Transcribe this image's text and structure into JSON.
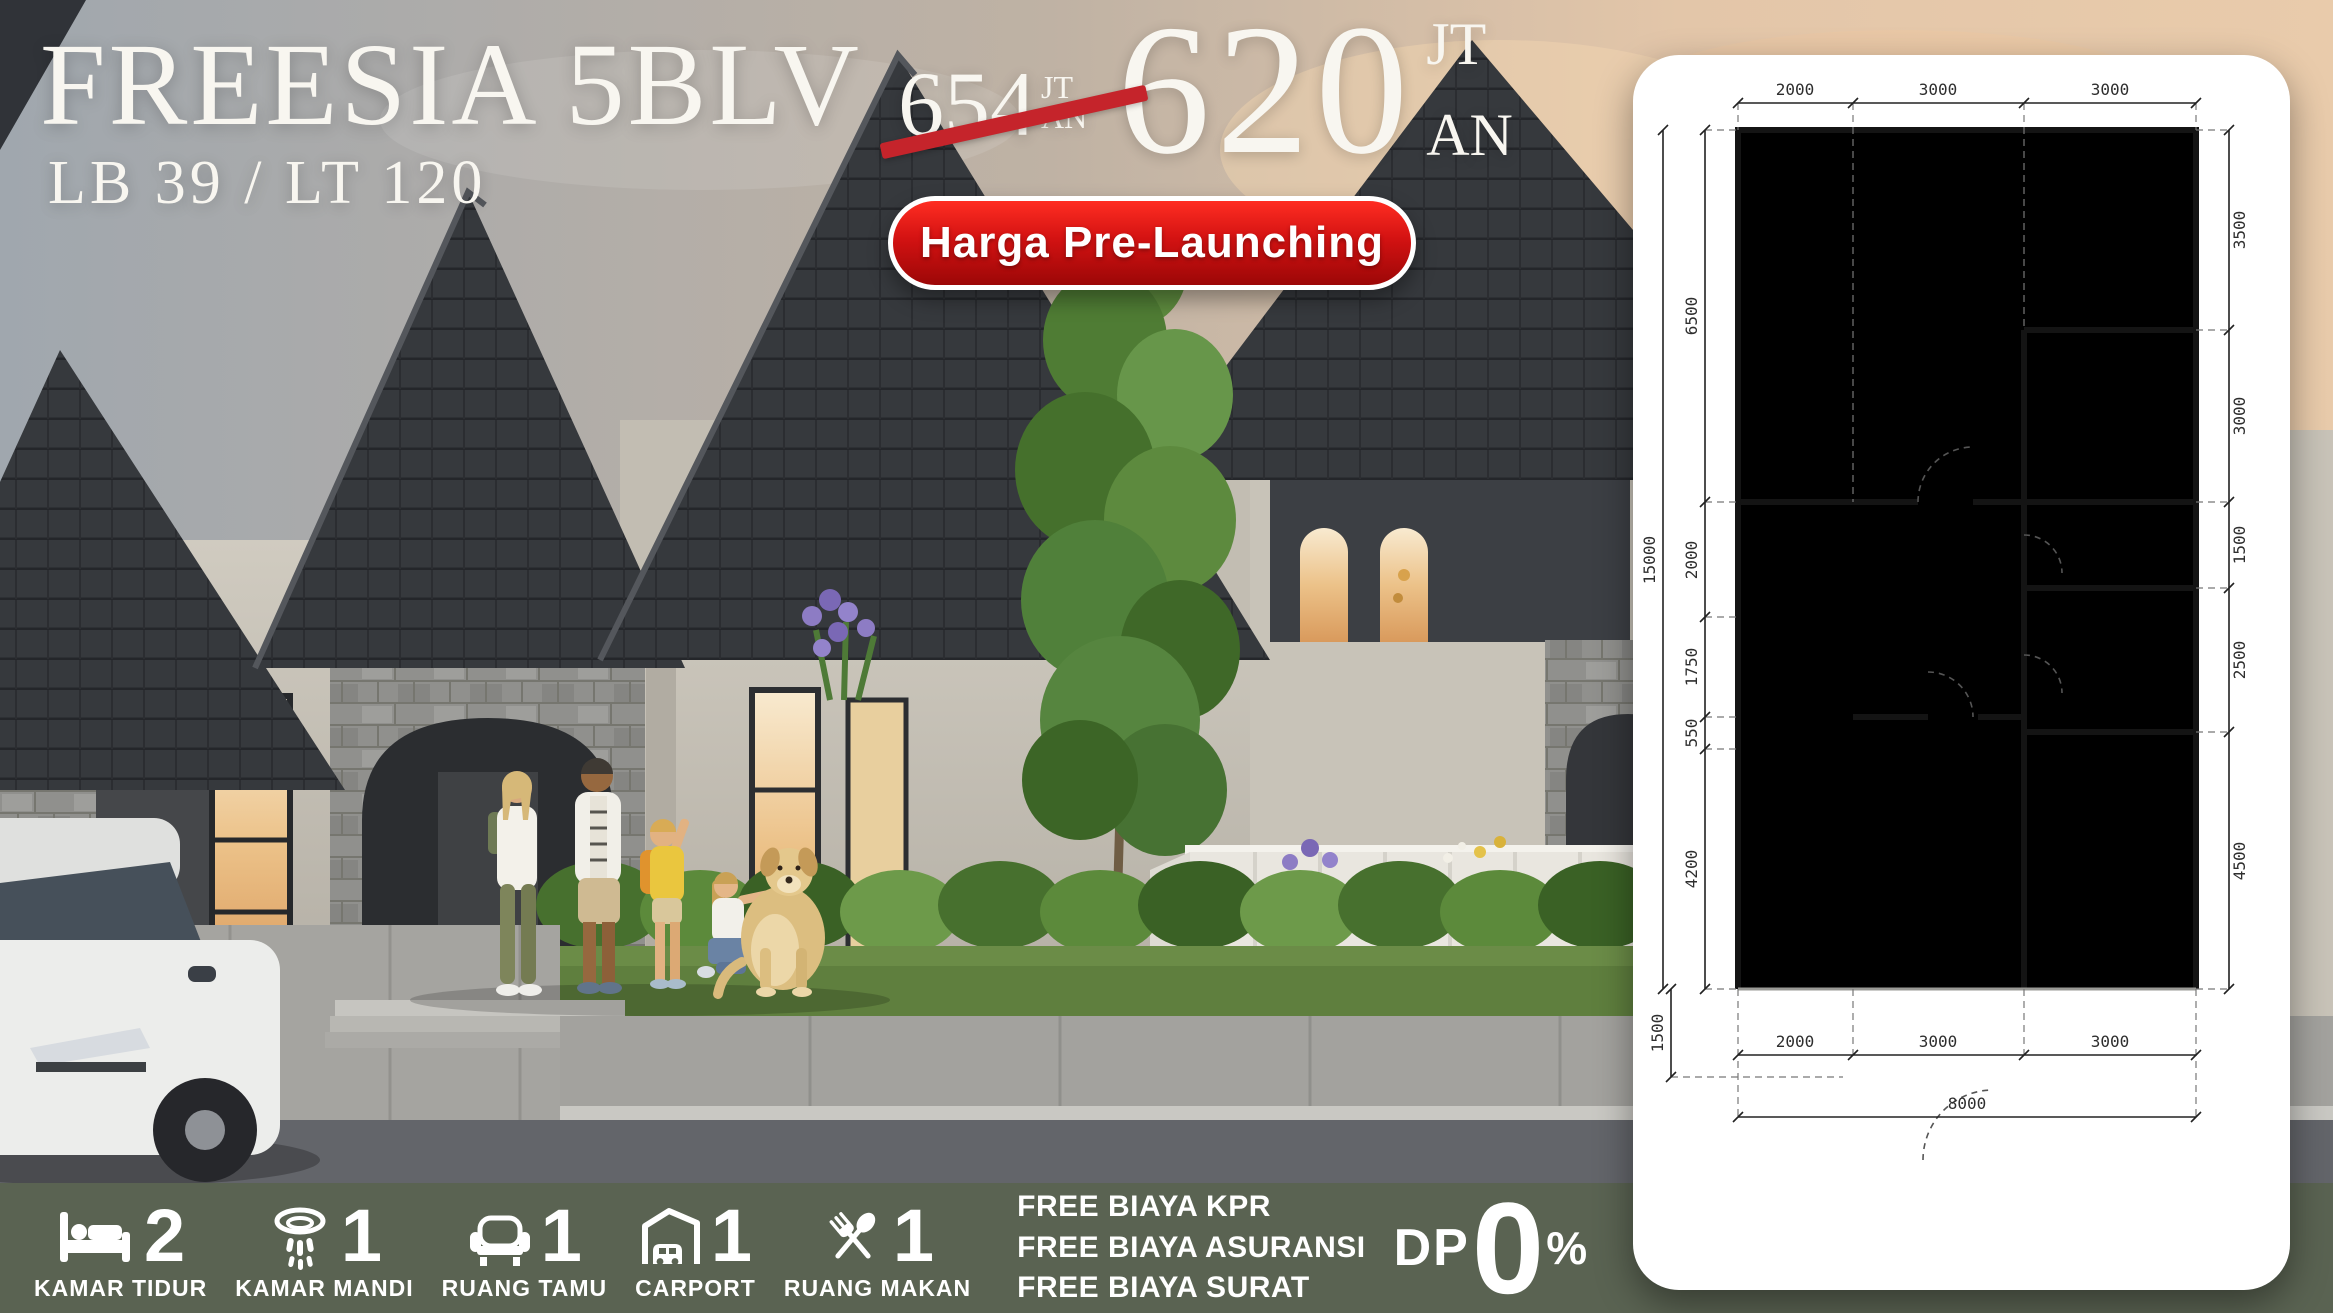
{
  "header": {
    "title": "FREESIA 5BLV",
    "spec": "LB 39 / LT 120"
  },
  "price": {
    "old": {
      "value": "654",
      "unit1": "JT",
      "unit2": "AN"
    },
    "new": {
      "value": "620",
      "unit1": "JT",
      "unit2": "AN"
    }
  },
  "badge": {
    "label": "Harga Pre-Launching"
  },
  "floorplan": {
    "top_dims": [
      "2000",
      "3000",
      "3000"
    ],
    "left_total": "15000",
    "left_dims": [
      "6500",
      "2000",
      "1750",
      "550",
      "4200"
    ],
    "left_front": "1500",
    "right_dims": [
      "3500",
      "3000",
      "1500",
      "2500",
      "4500"
    ],
    "bottom_dims": [
      "2000",
      "3000",
      "3000"
    ],
    "bottom_total": "8000"
  },
  "features": [
    {
      "icon": "bed-icon",
      "count": "2",
      "label": "KAMAR TIDUR"
    },
    {
      "icon": "shower-icon",
      "count": "1",
      "label": "KAMAR MANDI"
    },
    {
      "icon": "sofa-icon",
      "count": "1",
      "label": "RUANG TAMU"
    },
    {
      "icon": "carport-icon",
      "count": "1",
      "label": "CARPORT"
    },
    {
      "icon": "cutlery-icon",
      "count": "1",
      "label": "RUANG MAKAN"
    }
  ],
  "free_items": [
    "FREE BIAYA KPR",
    "FREE BIAYA ASURANSI",
    "FREE BIAYA SURAT"
  ],
  "dp": {
    "prefix": "DP",
    "value": "0",
    "suffix": "%"
  },
  "colors": {
    "accent_red": "#c5242b",
    "badge_red": "#d31212",
    "bar_green": "#5a6352",
    "roof_dark": "#36393d",
    "text_white": "#f8f6f0",
    "plan_grass": "#7aa04a",
    "car_blue": "#2f86d8"
  }
}
